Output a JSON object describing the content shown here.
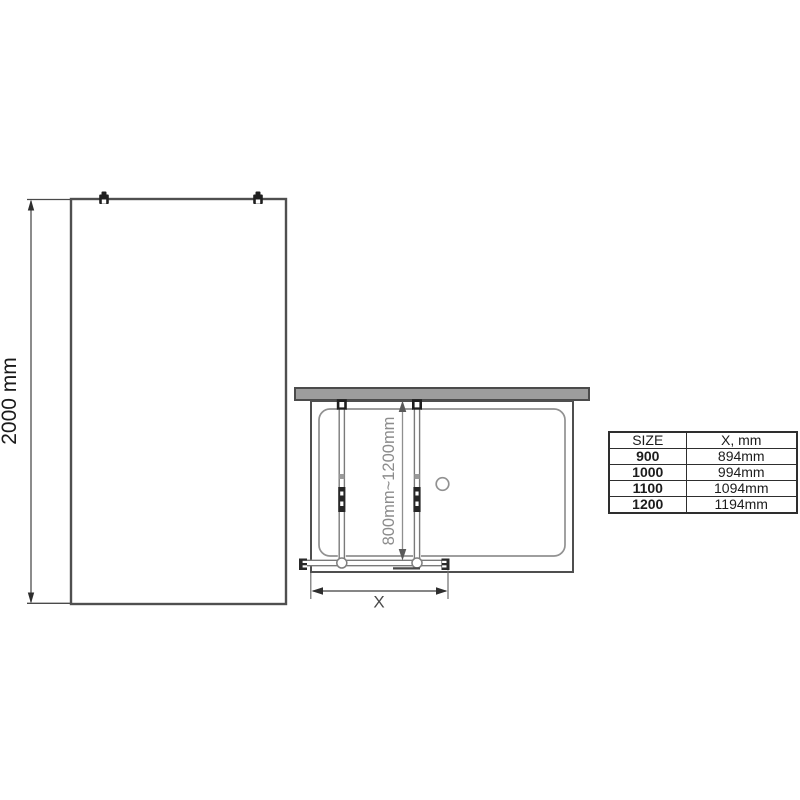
{
  "side_view": {
    "height_dimension": "2000 mm"
  },
  "plan_view": {
    "depth_dimension": "800mm~1200mm",
    "width_dimension_label": "X"
  },
  "size_table": {
    "headers": [
      "SIZE",
      "X, mm"
    ],
    "rows": [
      {
        "size": "900",
        "x": "894mm"
      },
      {
        "size": "1000",
        "x": "994mm"
      },
      {
        "size": "1100",
        "x": "1094mm"
      },
      {
        "size": "1200",
        "x": "1194mm"
      }
    ]
  },
  "colors": {
    "outline_dark": "#4a4a4a",
    "line_gray": "#8a8a8a",
    "wall_fill": "#9d9d9d",
    "fitting_black": "#1f1f1f",
    "dim_text_dark": "#1a1a1a",
    "dim_text_gray": "#8c8c8c"
  }
}
